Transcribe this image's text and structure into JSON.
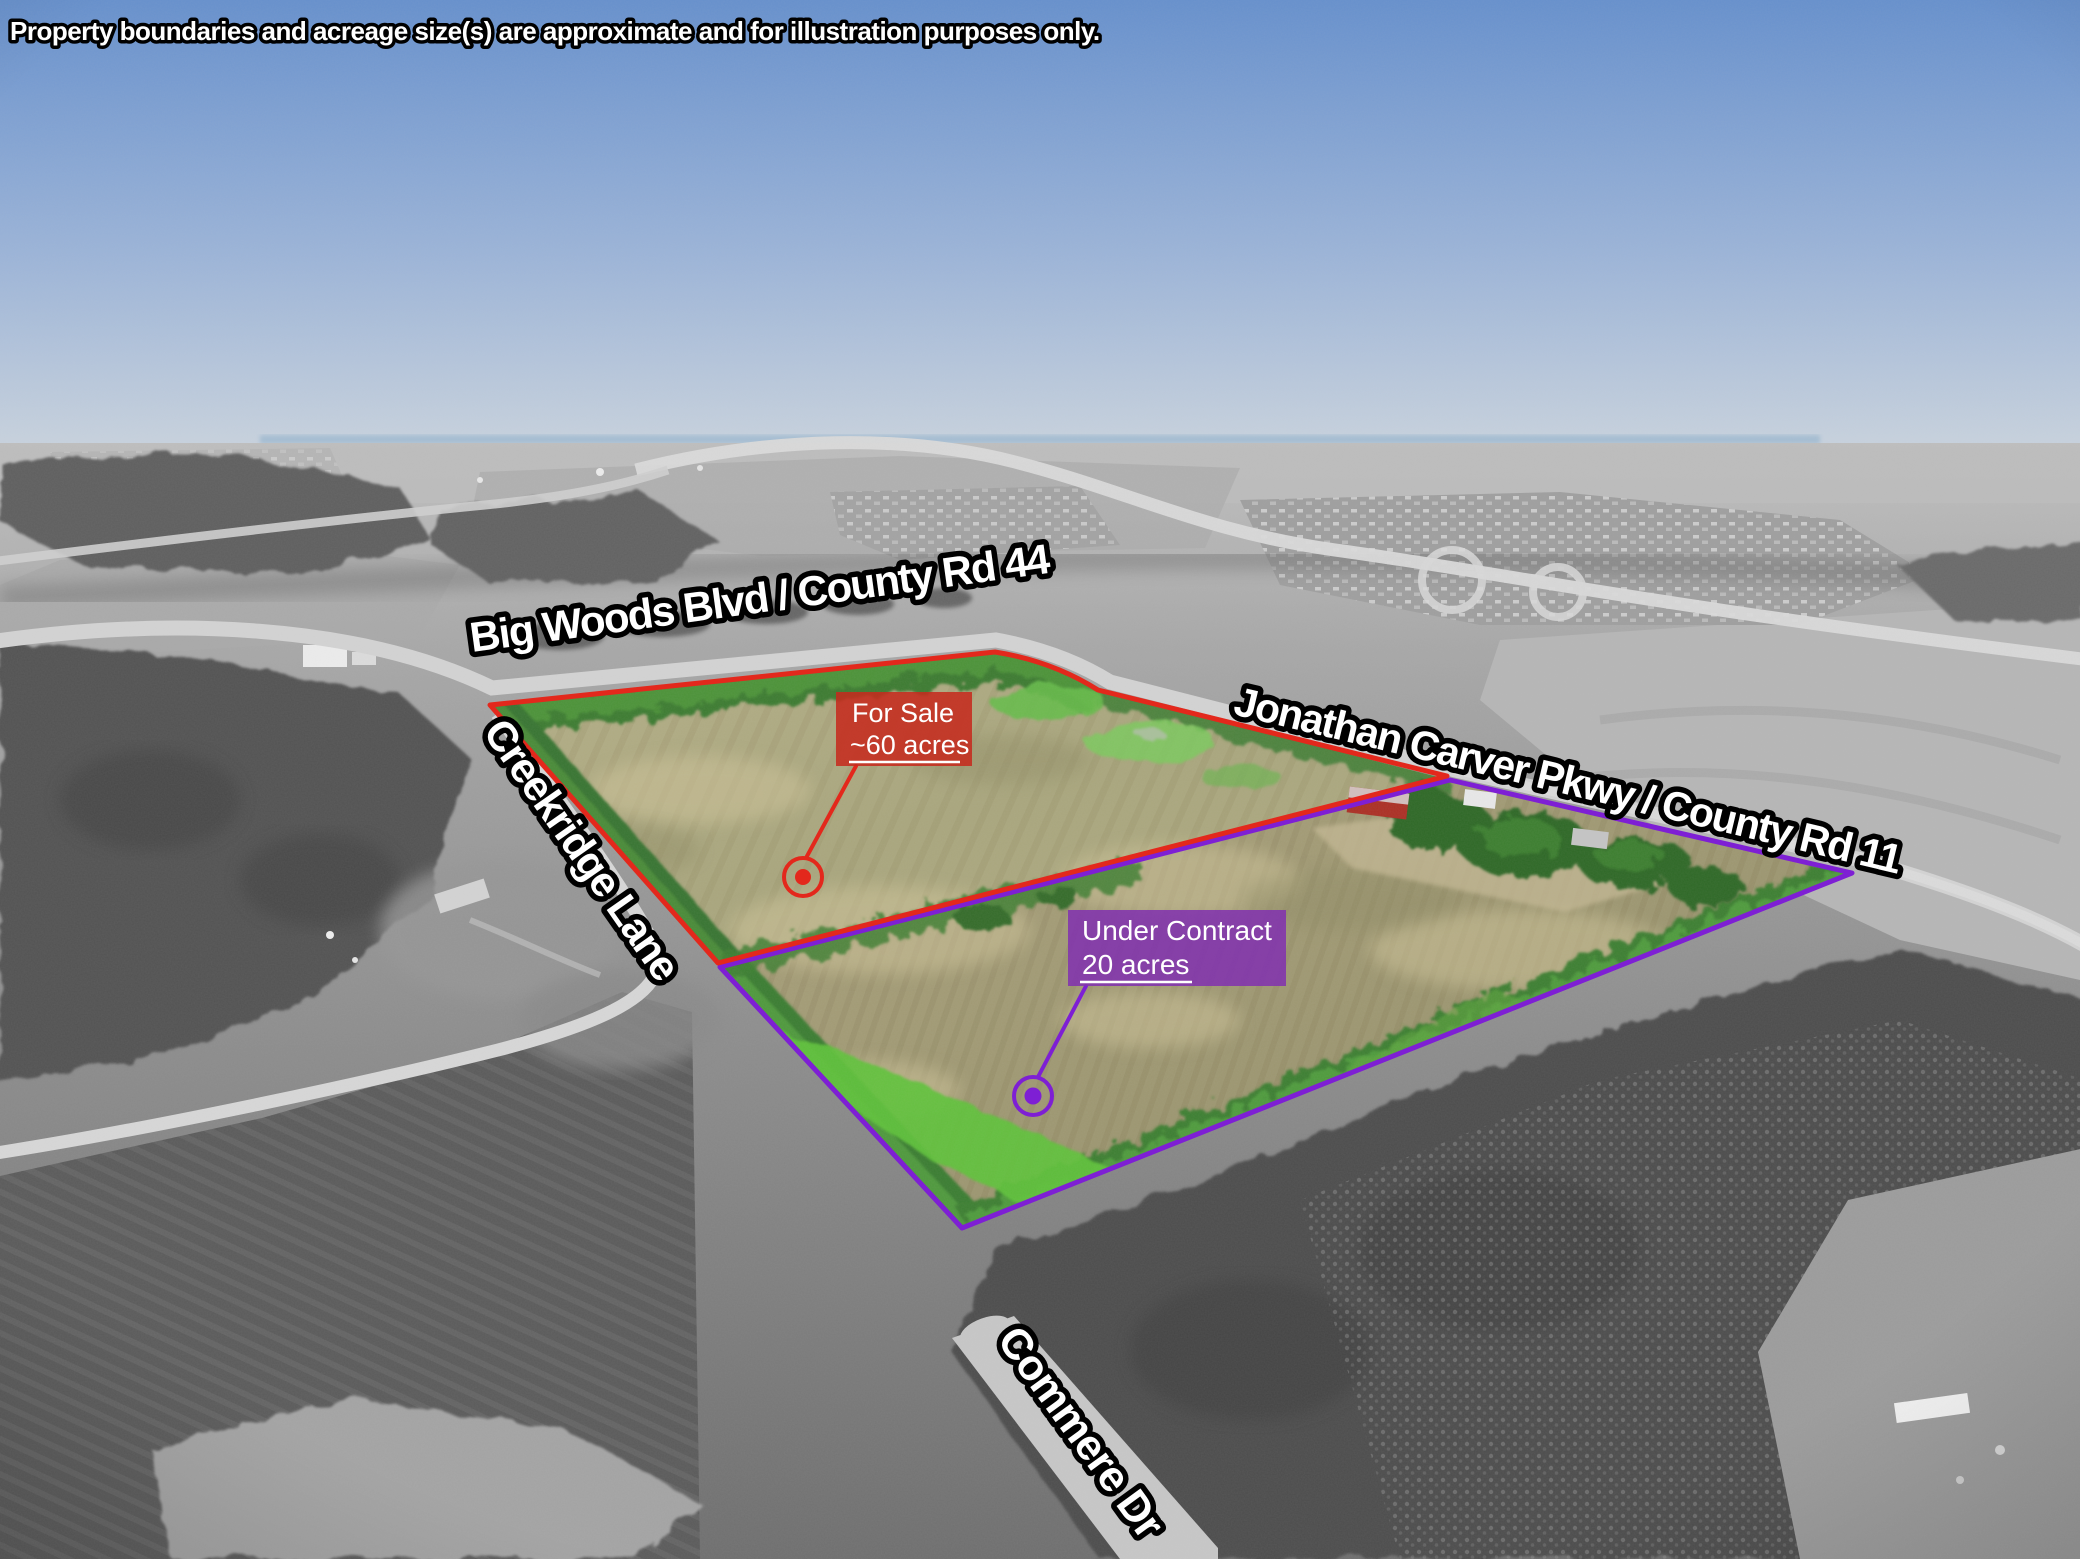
{
  "disclaimer": "Property boundaries and acreage size(s) are approximate and for illustration purposes only.",
  "road_labels": {
    "big_woods": "Big Woods Blvd / County Rd 44",
    "creekridge": "Creekridge Lane",
    "jonathan_carver": "Jonathan Carver Pkwy / County Rd 11",
    "commere": "Commere Dr"
  },
  "parcels": {
    "for_sale": {
      "status": "For Sale",
      "acreage": "~60 acres"
    },
    "under_contract": {
      "status": "Under Contract",
      "acreage": "20 acres"
    }
  },
  "colors": {
    "for_sale_boundary": "#e3281c",
    "for_sale_label_bg": "#c62a1e",
    "under_contract_boundary": "#7e1fd4",
    "under_contract_label_bg": "#8233ae",
    "label_text": "#ffffff",
    "outline_text_fill": "#ffffff",
    "outline_text_stroke": "#000000"
  }
}
